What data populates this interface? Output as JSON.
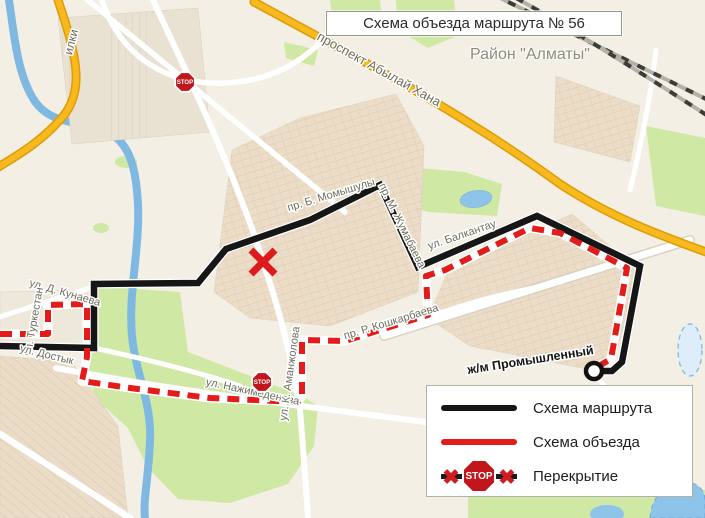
{
  "title": "Схема объезда маршрута № 56",
  "region_label": "Район \"Алматы\"",
  "legend": {
    "route_label": "Схема маршрута",
    "detour_label": "Схема объезда",
    "closure_label": "Перекрытие",
    "stop_text": "STOP"
  },
  "colors": {
    "route": "#161616",
    "detour": "#e41b1b",
    "stop_sign": "#c0161c",
    "closure_x": "#de1a1f",
    "highway": "#f7b91d",
    "water": "#7fb9e2",
    "green": "#cfe8a4",
    "label": "#6d6d5f"
  },
  "map": {
    "street_labels": [
      {
        "text": "проспект Абылай Хана",
        "x": 377,
        "y": 73,
        "rot": 29,
        "size": 13,
        "color": "#6f6b59"
      },
      {
        "text": "пр. Б. Момышулы",
        "x": 332,
        "y": 198,
        "rot": -17,
        "size": 11
      },
      {
        "text": "пр. М. Жумабаева",
        "x": 399,
        "y": 227,
        "rot": 64,
        "size": 11
      },
      {
        "text": "ул. Балкантау",
        "x": 463,
        "y": 238,
        "rot": -19,
        "size": 11
      },
      {
        "text": "пр. Р. Кошкарбаева",
        "x": 392,
        "y": 325,
        "rot": -17,
        "size": 11
      },
      {
        "text": "ул. Д. Кунаева",
        "x": 64,
        "y": 296,
        "rot": 16,
        "size": 11
      },
      {
        "text": "ул. Туркестан",
        "x": 37,
        "y": 322,
        "rot": -80,
        "size": 11
      },
      {
        "text": "ул. Достык",
        "x": 46,
        "y": 358,
        "rot": 14,
        "size": 11
      },
      {
        "text": "ул. Нажимеденова",
        "x": 252,
        "y": 395,
        "rot": 12,
        "size": 11
      },
      {
        "text": "ул. К. Аманжолова",
        "x": 293,
        "y": 374,
        "rot": -82,
        "size": 11
      },
      {
        "text": "илки",
        "x": 75,
        "y": 43,
        "rot": -76,
        "size": 12,
        "color": "#6f6b59"
      },
      {
        "text": "ж/м Промышленный",
        "x": 531,
        "y": 364,
        "rot": -9,
        "size": 12.5,
        "bold": true,
        "color": "#141414"
      }
    ],
    "stop_signs": [
      {
        "x": 185,
        "y": 82
      },
      {
        "x": 262,
        "y": 382
      }
    ],
    "closure_x": {
      "x": 263,
      "y": 262
    },
    "route_end_marker": {
      "x": 594,
      "y": 371
    },
    "routes": {
      "main": {
        "label": "Схема маршрута",
        "points": [
          [
            0,
            346
          ],
          [
            94,
            348
          ],
          [
            94,
            284
          ],
          [
            198,
            283
          ],
          [
            226,
            249
          ],
          [
            310,
            220
          ],
          [
            380,
            185
          ],
          [
            418,
            267
          ],
          [
            537,
            216
          ],
          [
            640,
            266
          ],
          [
            622,
            362
          ],
          [
            612,
            371
          ],
          [
            595,
            371
          ]
        ]
      },
      "detour": {
        "label": "Схема объезда",
        "points": [
          [
            0,
            334
          ],
          [
            48,
            334
          ],
          [
            48,
            305
          ],
          [
            87,
            304
          ],
          [
            87,
            357
          ],
          [
            82,
            381
          ],
          [
            130,
            388
          ],
          [
            210,
            398
          ],
          [
            298,
            402
          ],
          [
            302,
            396
          ],
          [
            302,
            340
          ],
          [
            345,
            341
          ],
          [
            428,
            315
          ],
          [
            426,
            276
          ],
          [
            445,
            270
          ],
          [
            530,
            228
          ],
          [
            560,
            233
          ],
          [
            627,
            268
          ],
          [
            611,
            359
          ],
          [
            597,
            367
          ]
        ]
      }
    }
  }
}
